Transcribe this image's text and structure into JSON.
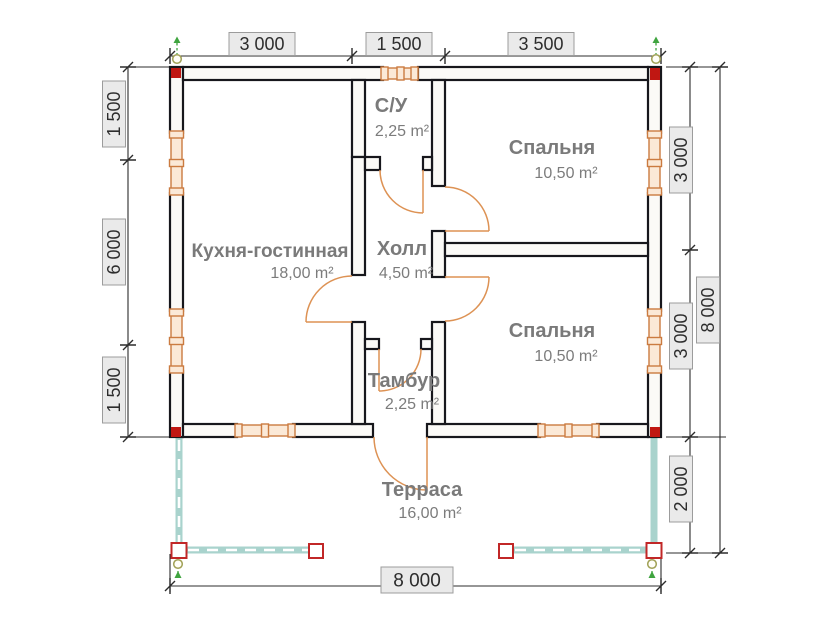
{
  "page": {
    "title": "План дома 8x8 с террасой"
  },
  "rooms": {
    "su": {
      "name": "С/У",
      "area": "2,25 m²"
    },
    "bedroom1": {
      "name": "Спальня",
      "area": "10,50 m²"
    },
    "kitchen": {
      "name": "Кухня-гостинная",
      "area": "18,00 m²"
    },
    "hall": {
      "name": "Холл",
      "area": "4,50 m²"
    },
    "bedroom2": {
      "name": "Спальня",
      "area": "10,50 m²"
    },
    "tambur": {
      "name": "Тамбур",
      "area": "2,25 m²"
    },
    "terrace": {
      "name": "Терраса",
      "area": "16,00 m²"
    }
  },
  "dimensions": {
    "top": [
      "3 000",
      "1 500",
      "3 500"
    ],
    "left": [
      "1 500",
      "6 000",
      "1 500"
    ],
    "right_inner": [
      "3 000",
      "3 000",
      "2 000"
    ],
    "right_outer": "8 000",
    "bottom": "8 000"
  },
  "colors": {
    "walls": "#17171c",
    "windows": "#cb7b40",
    "doors": "#dd9254",
    "terrace": "#a9d3cd",
    "corner_marker": "#c01712",
    "room_labels": "#7a7a7a",
    "dim_label_bg": "#eaeaea"
  }
}
